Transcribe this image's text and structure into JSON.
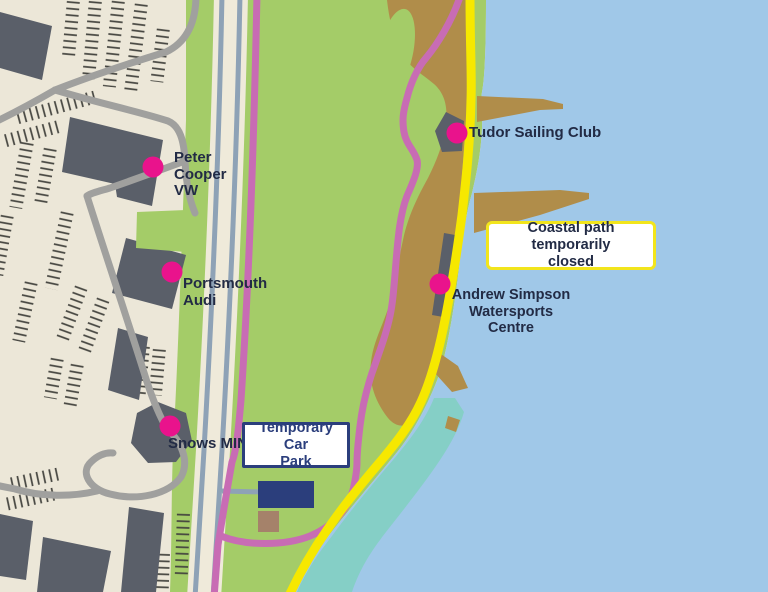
{
  "title": "Portsmouth coastal area map",
  "labels": {
    "peter_cooper": "Peter\nCooper\nVW",
    "portsmouth_audi": "Portsmouth\nAudi",
    "snows_mini": "Snows MINI",
    "tudor_sailing_club": "Tudor Sailing Club",
    "watersports_centre": "Andrew Simpson\nWatersports Centre",
    "temporary_car_park": "Temporary Car\nPark",
    "coastal_path_notice": "Coastal path temporarily\nclosed"
  },
  "colors": {
    "background": "#ece7d8",
    "park_green": "#a4cc68",
    "water_blue": "#a0c8e8",
    "shallow_teal": "#85cfc6",
    "mudflat_brown": "#b08d4a",
    "sand_brown": "#a5826a",
    "path_pink": "#c86cb4",
    "marker_magenta": "#e9138c",
    "path_yellow": "#f6e800",
    "road_gray": "#a0a09e",
    "road_cream": "#efeada",
    "road_line_slate": "#8ea2b6",
    "building_gray": "#5a5f69",
    "navy": "#2b3e7c",
    "label_text": "#222b45",
    "box_border_yellow": "#f2e51c"
  }
}
